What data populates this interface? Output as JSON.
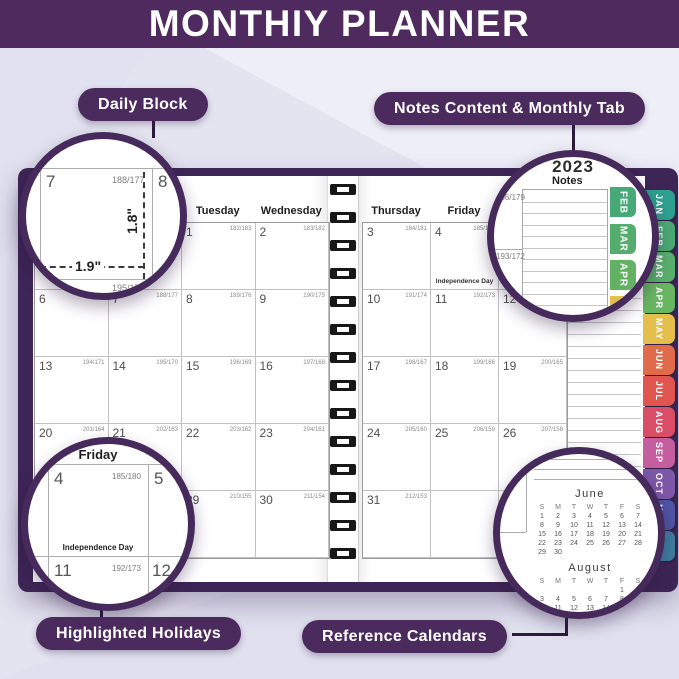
{
  "theme": {
    "banner_purple": "#4e2a5e",
    "cover_purple": "#3d2655",
    "ring_purple": "#472a5c",
    "pill_purple": "#4b2a5e",
    "background": "#e4e4f0"
  },
  "banner": {
    "title": "MONTHIY PLANNER"
  },
  "callouts": {
    "daily_block": "Daily Block",
    "notes_tab": "Notes Content & Monthly Tab",
    "holidays": "Highlighted Holidays",
    "reference": "Reference Calendars"
  },
  "planner": {
    "left_day_headers": [
      "Sunday",
      "Monday",
      "Tuesday",
      "Wednesday"
    ],
    "right_day_headers": [
      "Thursday",
      "Friday",
      "Saturday"
    ],
    "notes_label": "Notes",
    "holiday_label": "Independence Day",
    "left_cells": [
      [
        null,
        null,
        {
          "day": "1",
          "note": "182/183"
        },
        {
          "day": "2",
          "note": "183/182"
        }
      ],
      [
        {
          "day": "6",
          "note": "187/178"
        },
        {
          "day": "7",
          "note": "188/177"
        },
        {
          "day": "8",
          "note": "189/176"
        },
        {
          "day": "9",
          "note": "190/175"
        }
      ],
      [
        {
          "day": "13",
          "note": "194/171"
        },
        {
          "day": "14",
          "note": "195/170"
        },
        {
          "day": "15",
          "note": "196/169"
        },
        {
          "day": "16",
          "note": "197/168"
        }
      ],
      [
        {
          "day": "20",
          "note": "201/164"
        },
        {
          "day": "21",
          "note": "202/163"
        },
        {
          "day": "22",
          "note": "203/162"
        },
        {
          "day": "23",
          "note": "204/161"
        }
      ],
      [
        {
          "day": "27",
          "note": "208/157"
        },
        {
          "day": "28",
          "note": "209/156"
        },
        {
          "day": "29",
          "note": "210/155"
        },
        {
          "day": "30",
          "note": "211/154"
        }
      ]
    ],
    "right_cells": [
      [
        {
          "day": "3",
          "note": "184/181"
        },
        {
          "day": "4",
          "note": "185/180",
          "holiday": true
        },
        {
          "day": "5",
          "note": "186/179"
        }
      ],
      [
        {
          "day": "10",
          "note": "191/174"
        },
        {
          "day": "11",
          "note": "192/173"
        },
        {
          "day": "12",
          "note": "193/172"
        }
      ],
      [
        {
          "day": "17",
          "note": "198/167"
        },
        {
          "day": "18",
          "note": "199/166"
        },
        {
          "day": "19",
          "note": "200/165"
        }
      ],
      [
        {
          "day": "24",
          "note": "205/160"
        },
        {
          "day": "25",
          "note": "206/159"
        },
        {
          "day": "26",
          "note": "207/158"
        }
      ],
      [
        {
          "day": "31",
          "note": "212/153"
        },
        null,
        null
      ]
    ],
    "tabs": [
      {
        "label": "JAN",
        "color": "#2fa08f"
      },
      {
        "label": "FEB",
        "color": "#4aaa74"
      },
      {
        "label": "MAR",
        "color": "#58b06c"
      },
      {
        "label": "APR",
        "color": "#68b562"
      },
      {
        "label": "MAY",
        "color": "#e5bf4b"
      },
      {
        "label": "JUN",
        "color": "#df6b4a"
      },
      {
        "label": "JUL",
        "color": "#e0564e"
      },
      {
        "label": "AUG",
        "color": "#d94e66"
      },
      {
        "label": "SEP",
        "color": "#c55e9f"
      },
      {
        "label": "OCT",
        "color": "#7e58a8"
      },
      {
        "label": "NOV",
        "color": "#4f55a5"
      },
      {
        "label": "DEC",
        "color": "#3e7fa3"
      }
    ]
  },
  "magnifiers": {
    "daily_block": {
      "day": "7",
      "note": "188/177",
      "next_day": "8",
      "below_day": "14",
      "below_note": "195/170",
      "width_label": "1.9\"",
      "height_label": "1.8\""
    },
    "notes": {
      "year": "2023",
      "day_header_fragment": "ay",
      "notes_label": "Notes",
      "note_top": "186/179",
      "note_bottom": "193/172",
      "tabs": [
        {
          "label": "FEB",
          "color": "#47a878"
        },
        {
          "label": "MAR",
          "color": "#55ad6d"
        },
        {
          "label": "APR",
          "color": "#63b263"
        },
        {
          "label": "MAY",
          "color": "#e5bf4b"
        }
      ]
    },
    "holidays": {
      "day_header": "Friday",
      "day": "4",
      "note": "185/180",
      "holiday": "Independence Day",
      "right_day": "5",
      "below_day": "11",
      "below_note": "192/173",
      "right_below_day": "12",
      "left_fragment_top": "81",
      "left_fragment_bottom": "74"
    },
    "reference": {
      "june": {
        "title": "June",
        "dow": [
          "S",
          "M",
          "T",
          "W",
          "T",
          "F",
          "S"
        ],
        "weeks": [
          [
            "1",
            "2",
            "3",
            "4",
            "5",
            "6",
            "7"
          ],
          [
            "8",
            "9",
            "10",
            "11",
            "12",
            "13",
            "14"
          ],
          [
            "15",
            "16",
            "17",
            "18",
            "19",
            "20",
            "21"
          ],
          [
            "22",
            "23",
            "24",
            "25",
            "26",
            "27",
            "28"
          ],
          [
            "29",
            "30",
            "",
            "",
            "",
            "",
            ""
          ]
        ]
      },
      "august": {
        "title": "August",
        "dow": [
          "S",
          "M",
          "T",
          "W",
          "T",
          "F",
          "S"
        ],
        "weeks": [
          [
            "",
            "",
            "",
            "",
            "",
            "1",
            "2"
          ],
          [
            "3",
            "4",
            "5",
            "6",
            "7",
            "8",
            "9"
          ],
          [
            "10",
            "11",
            "12",
            "13",
            "14",
            "15",
            "16"
          ],
          [
            "17",
            "18",
            "19",
            "20",
            "21",
            "22",
            "23"
          ],
          [
            "24",
            "25",
            "26",
            "27",
            "28",
            "29",
            "30"
          ],
          [
            "31",
            "",
            "",
            "",
            "",
            "",
            ""
          ]
        ]
      }
    }
  }
}
